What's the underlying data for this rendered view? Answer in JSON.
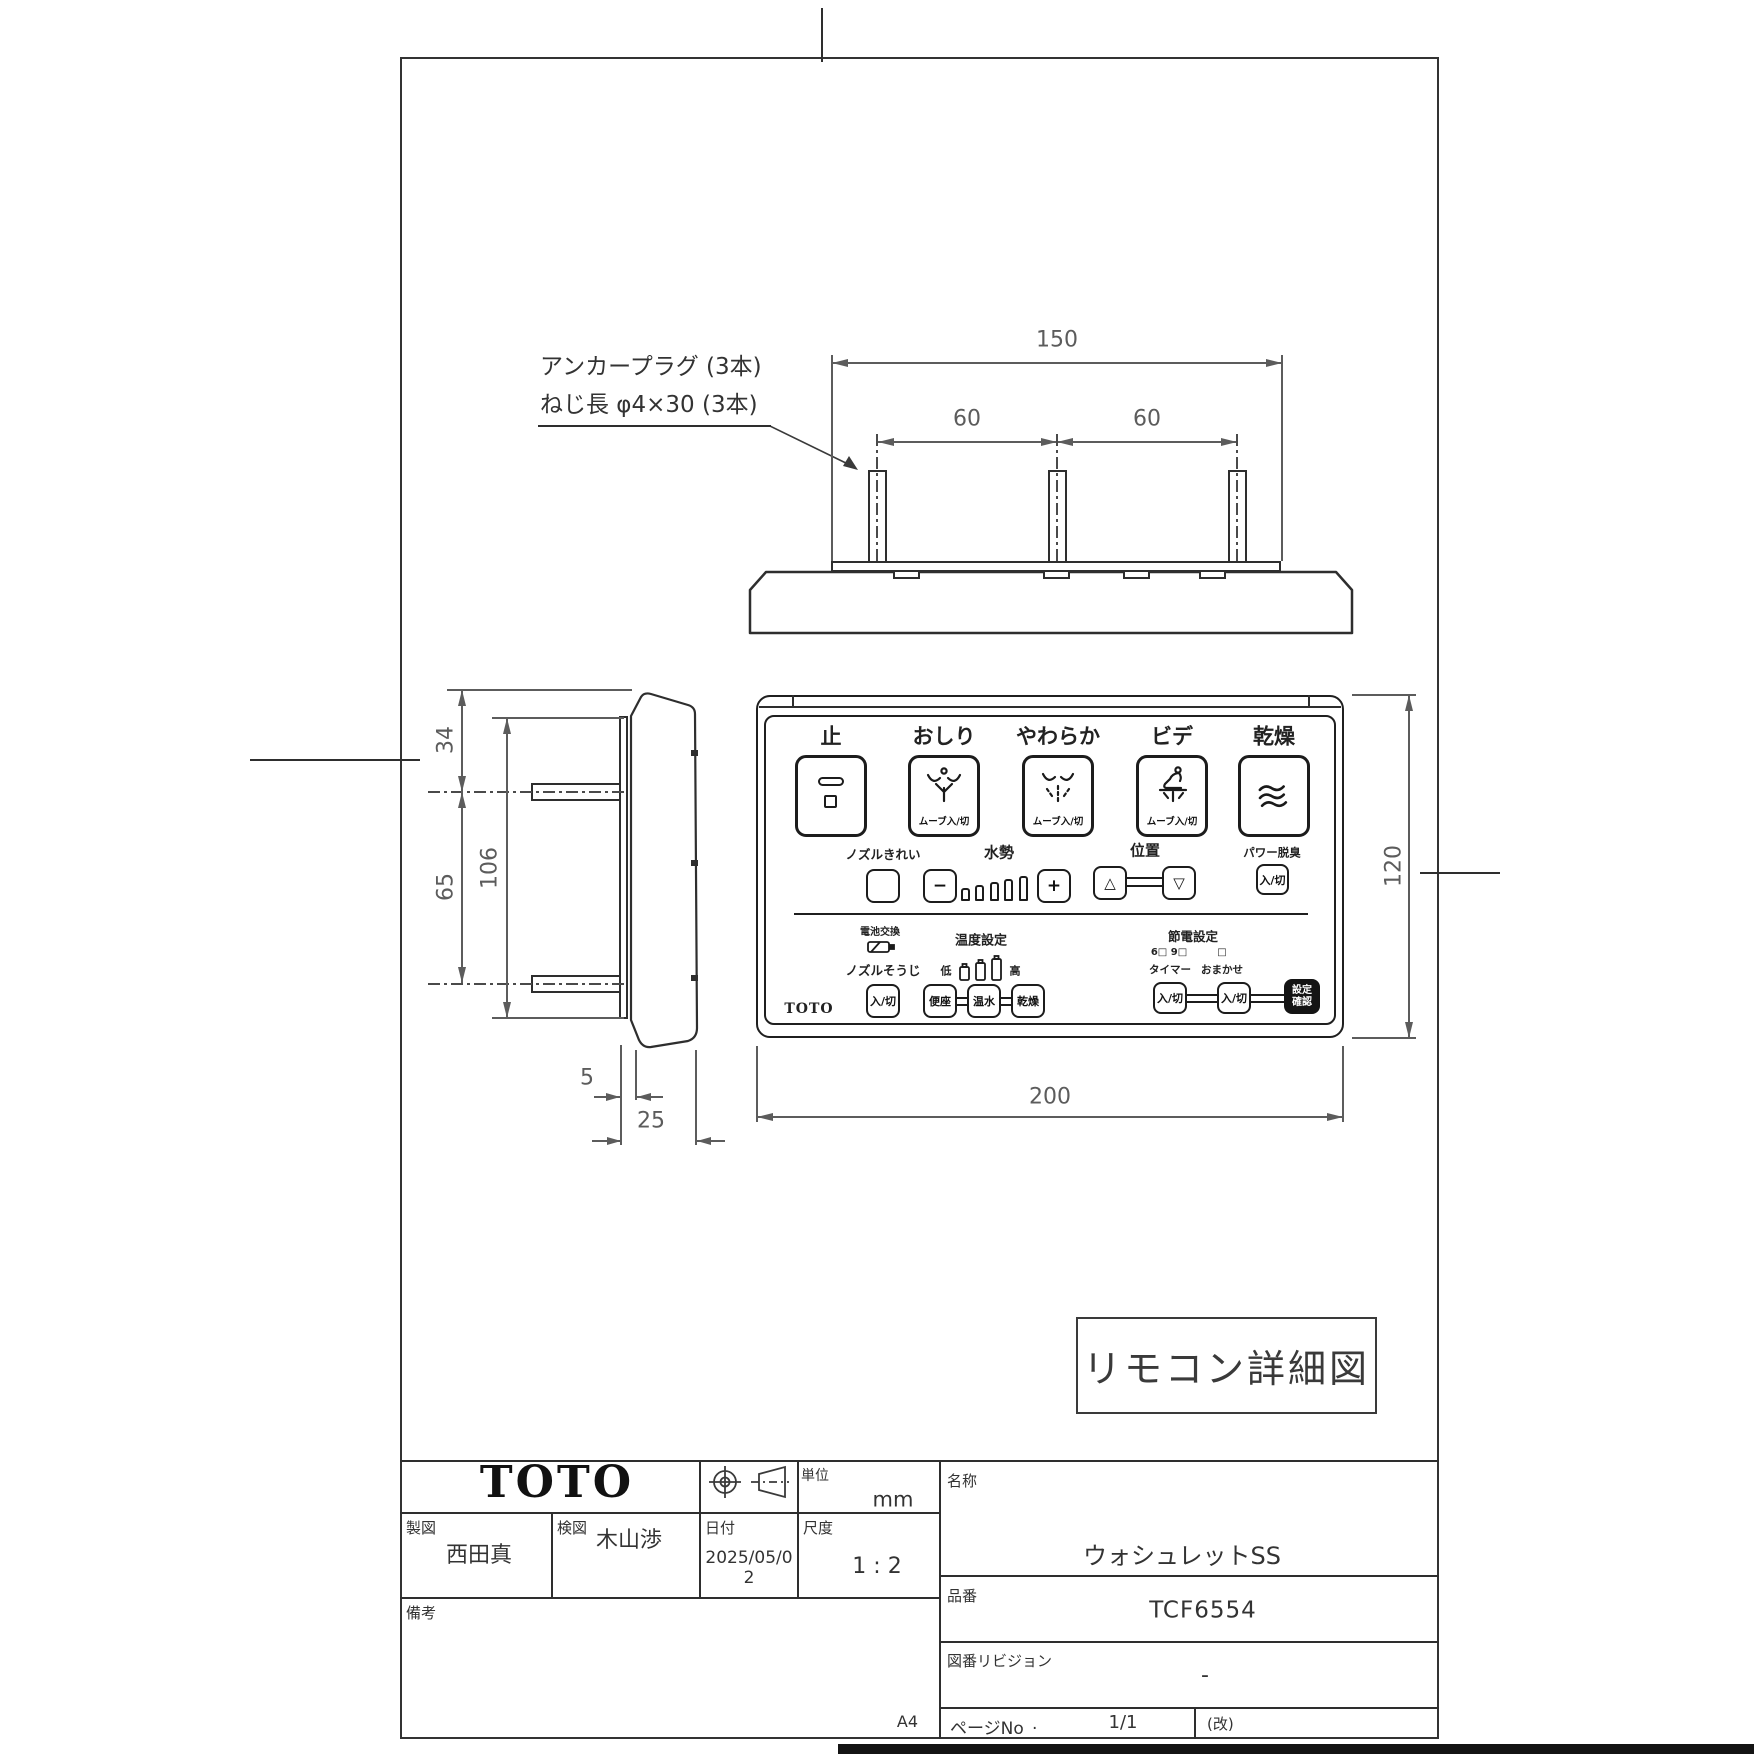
{
  "colors": {
    "paper": "#ffffff",
    "object_line": "#2e2e2e",
    "dim_line": "#5c5c5c",
    "ink": "#222222",
    "confirm_button_bg": "#141414"
  },
  "annotation": {
    "line1": "アンカープラグ (3本)",
    "line2": "ねじ長 φ4×30 (3本)"
  },
  "dims": {
    "overall_top": "150",
    "pitch_left": "60",
    "pitch_right": "60",
    "front_width": "200",
    "front_height": "120",
    "side_top": "34",
    "side_pitch": "65",
    "side_plate": "106",
    "side_gap": "5",
    "side_depth": "25"
  },
  "remote": {
    "brand": "TOTO",
    "onoff": "入/切",
    "row1": {
      "stop": "止",
      "oshiri": "おしり",
      "soft": "やわらか",
      "bidet": "ビデ",
      "dry": "乾燥",
      "move": "ムーブ入/切"
    },
    "row2": {
      "nozzle_clean": "ノズルきれい",
      "water": "水勢",
      "minus": "−",
      "plus": "+",
      "position": "位置",
      "up": "△",
      "down": "▽",
      "deodorizer": "パワー脱臭"
    },
    "row3": {
      "battery": "電池交換",
      "nozzle_wash": "ノズルそうじ",
      "temp": "温度設定",
      "low": "低",
      "high": "高",
      "seat": "便座",
      "warm_water": "温水",
      "dry": "乾燥",
      "eco": "節電設定",
      "eco_opts_timer": "6□ 9□",
      "eco_opt_auto": "□",
      "timer": "タイマー",
      "auto": "おまかせ",
      "confirm1": "設定",
      "confirm2": "確認"
    }
  },
  "stamp": {
    "label": "リモコン詳細図"
  },
  "title": {
    "logo": "TOTO",
    "unit_label": "単位",
    "unit": "mm",
    "drafter_label": "製図",
    "drafter": "西田真",
    "checker_label": "検図",
    "checker": "木山渉",
    "date_label": "日付",
    "date": "2025/05/02",
    "scale_label": "尺度",
    "scale": "1 : 2",
    "remarks_label": "備考",
    "name_label": "名称",
    "name": "ウォシュレットSS",
    "part_label": "品番",
    "part": "TCF6554",
    "rev_label": "図番リビジョン",
    "rev": "-",
    "page_label": "ページNo",
    "page_dot": ".",
    "page": "1/1",
    "rev_mark": "(改)",
    "size": "A4"
  }
}
